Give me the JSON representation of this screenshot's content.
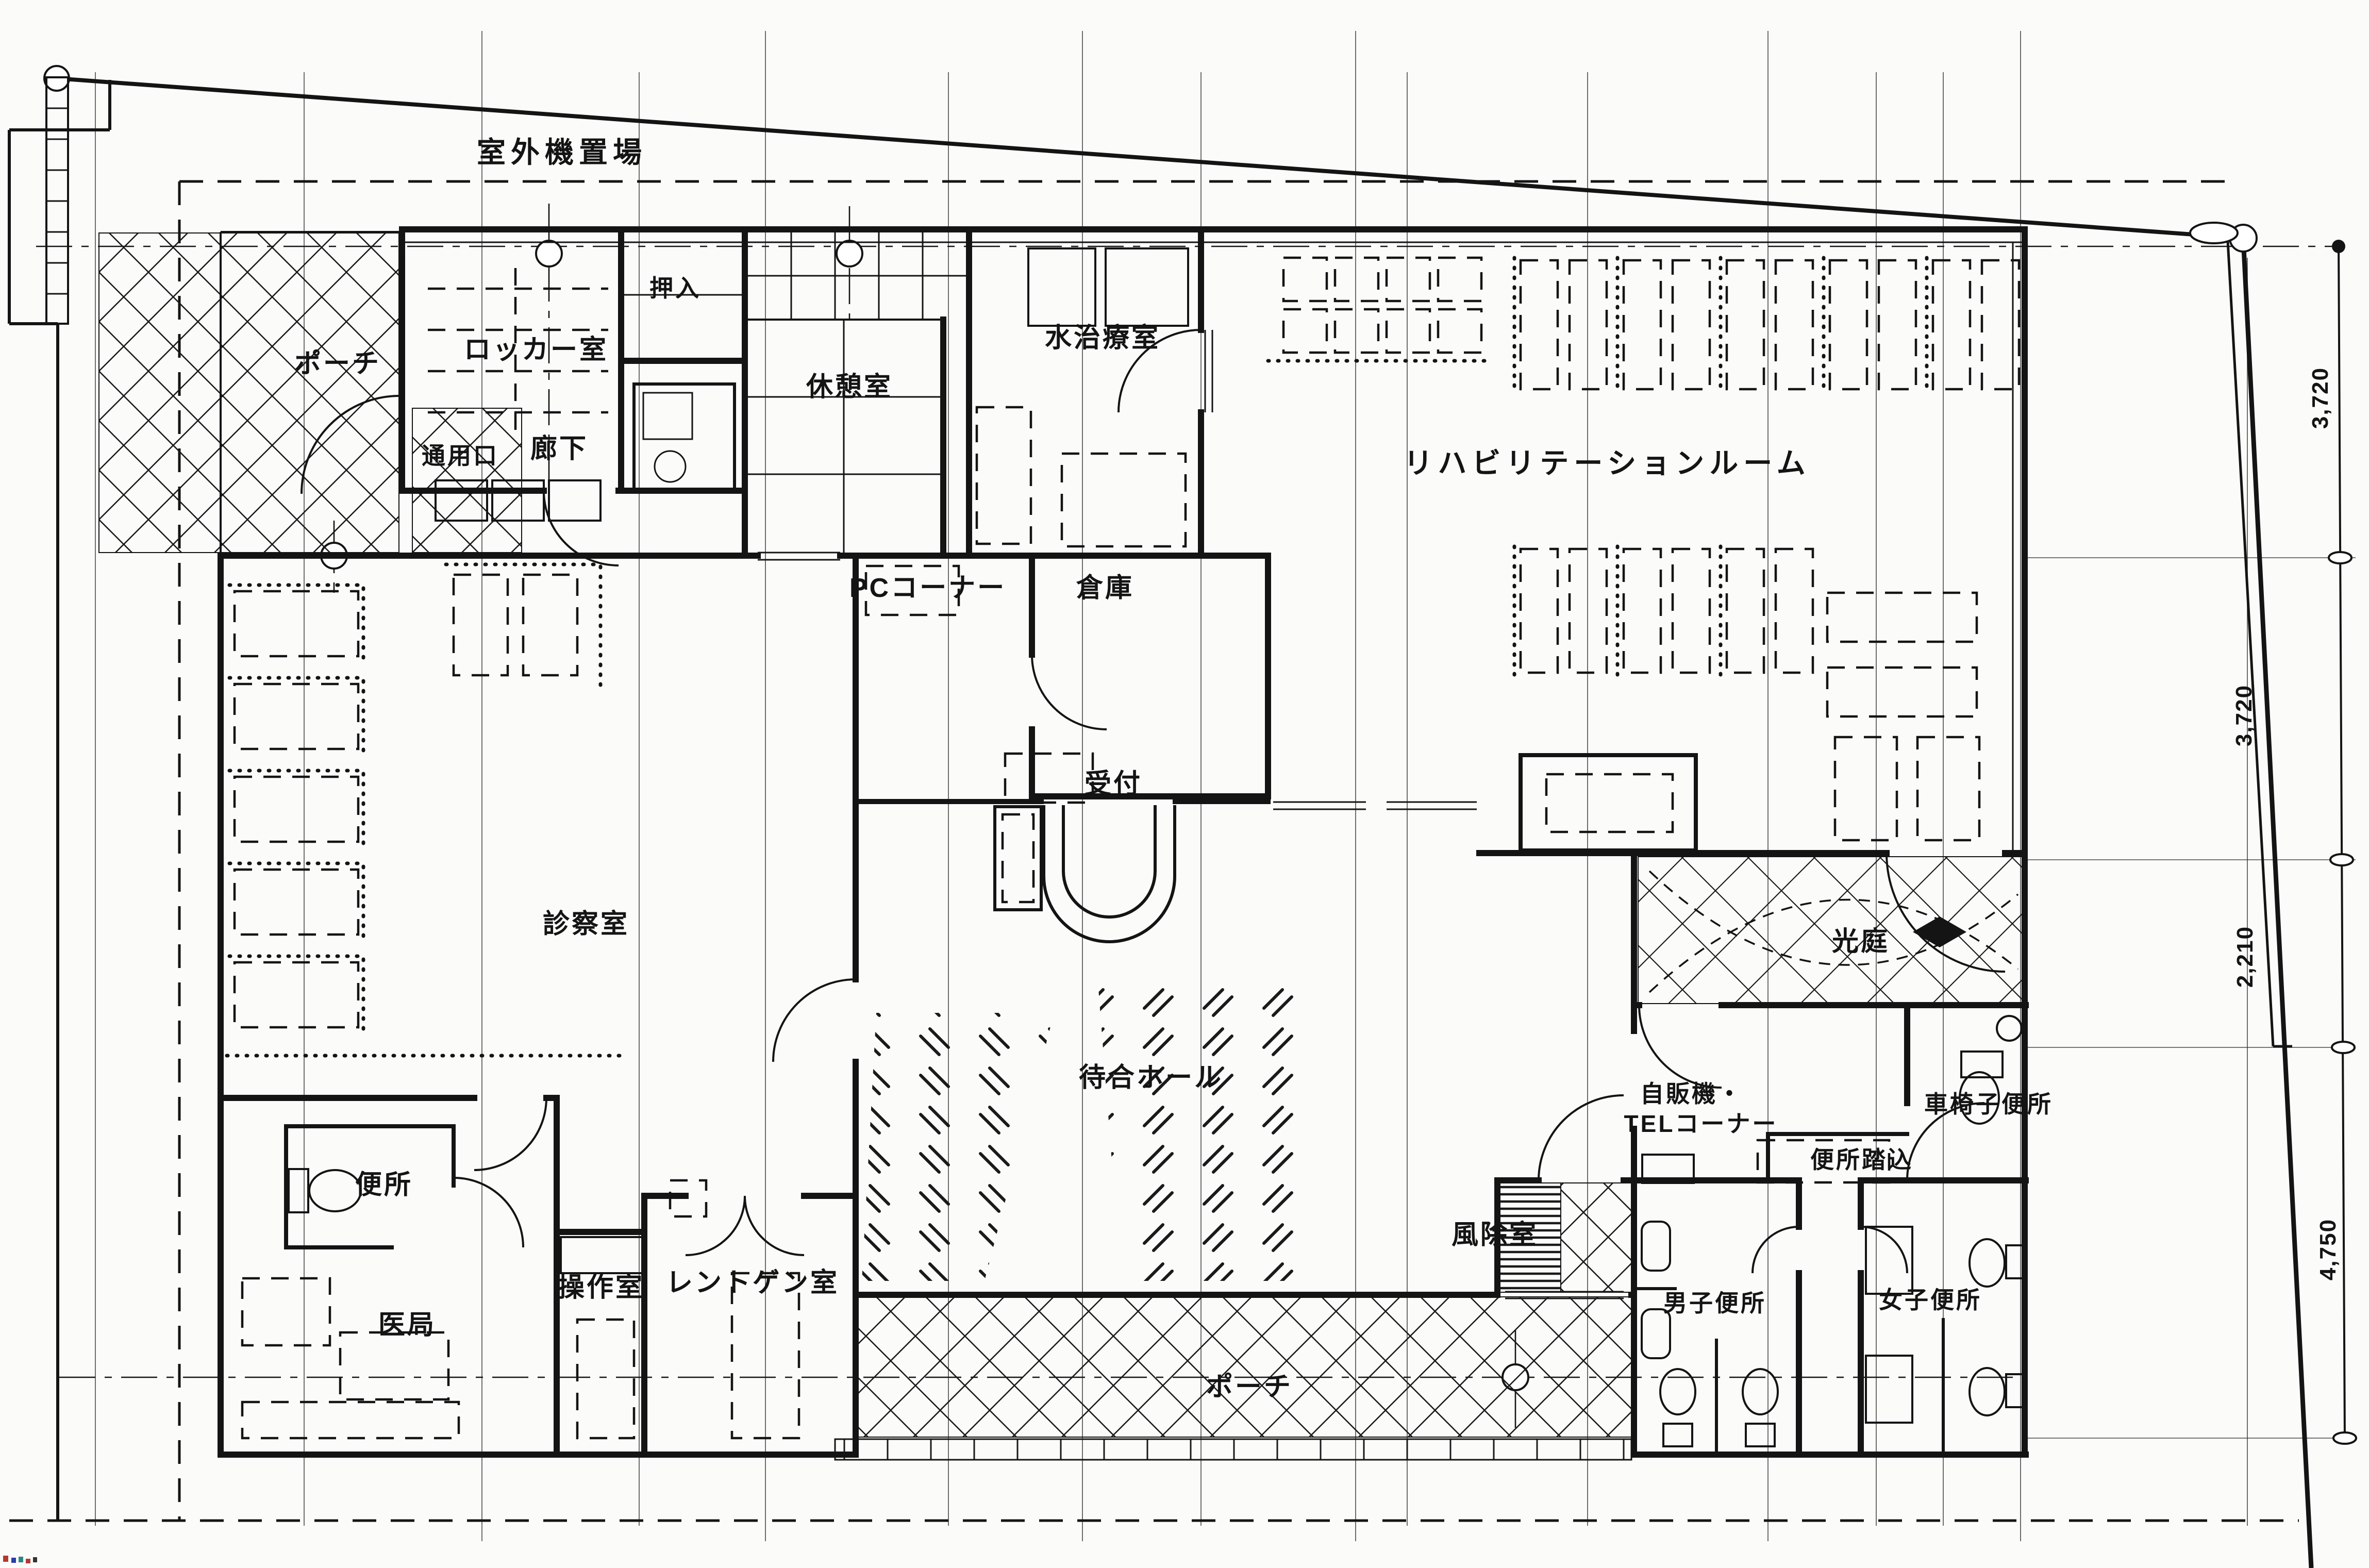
{
  "site": {
    "outdoor_unit_area": "室外機置場"
  },
  "rooms": {
    "porch_nw": "ポーチ",
    "closet": "押入",
    "locker_room": "ロッカー室",
    "break_room": "休憩室",
    "hydrotherapy_room": "水治療室",
    "service_entrance": "通用口",
    "corridor": "廊下",
    "rehabilitation_room": "リハビリテーションルーム",
    "pc_corner": "PCコーナー",
    "storage": "倉庫",
    "reception": "受付",
    "examination_room": "診察室",
    "waiting_hall": "待合ホール",
    "light_court": "光庭",
    "vending_tel_line1": "自販機・",
    "vending_tel_line2": "TELコーナー",
    "wheelchair_toilet": "車椅子便所",
    "toilet_vestibule": "便所踏込",
    "staff_toilet": "便所",
    "control_room": "操作室",
    "xray_room": "レントゲン室",
    "doctors_office": "医局",
    "windbreak_room": "風除室",
    "mens_toilet": "男子便所",
    "womens_toilet": "女子便所",
    "porch_south": "ポーチ"
  },
  "dimensions": {
    "right_top": "3,720",
    "right_upper": "3,720",
    "right_middle": "2,210",
    "right_lower": "4,750"
  }
}
